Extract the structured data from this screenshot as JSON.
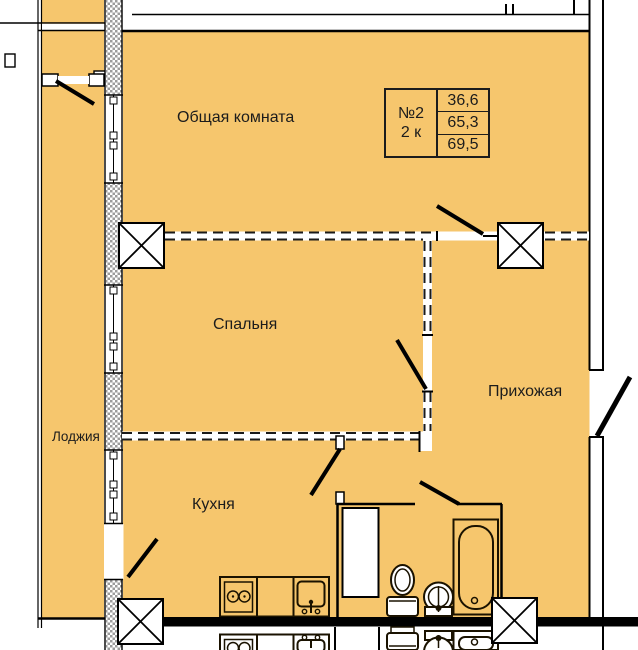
{
  "unit_info": {
    "number": "№2",
    "rooms_type": "2 к",
    "area_living": "36,6",
    "area_usable": "65,3",
    "area_total": "69,5"
  },
  "labels": {
    "living_room": "Общая комната",
    "bedroom": "Спальня",
    "hallway": "Прихожая",
    "kitchen": "Кухня",
    "loggia": "Лоджия"
  },
  "colors": {
    "floor": "#F6C66D",
    "walls": "#000000",
    "hatch": "#9C9C9C"
  }
}
